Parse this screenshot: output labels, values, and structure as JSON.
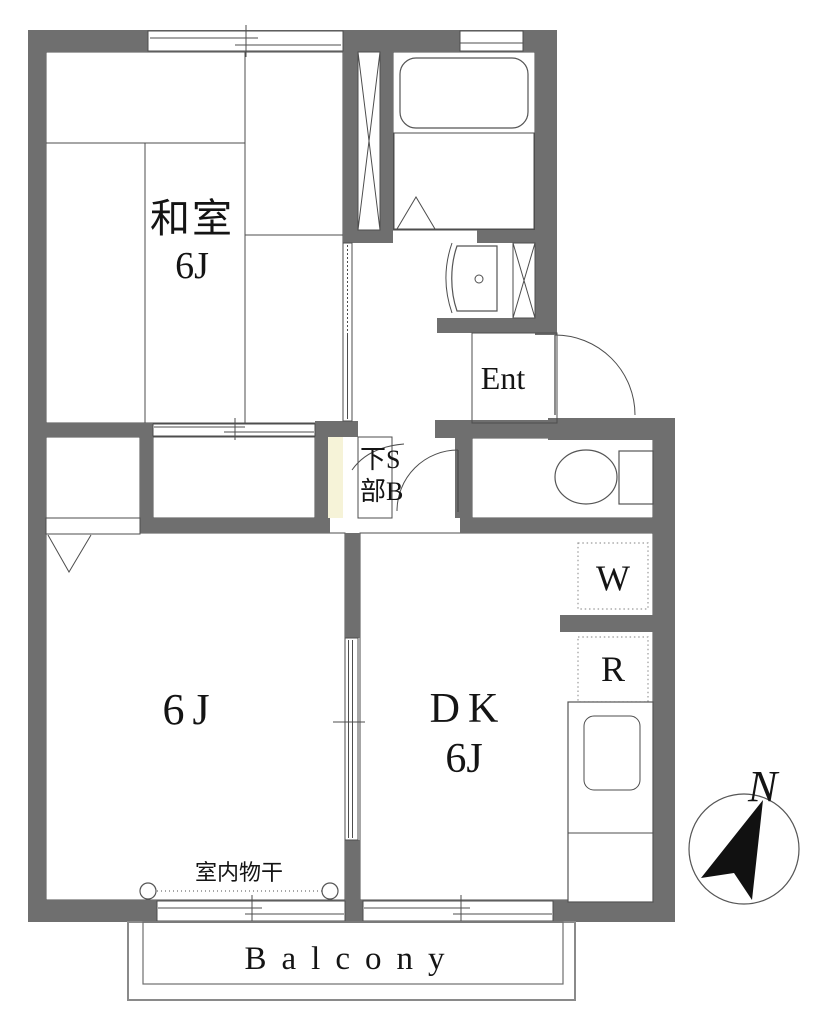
{
  "figure": {
    "type": "apartment-floor-plan"
  },
  "palette": {
    "wall": "#6f6f6f",
    "tatami": "#dfecdf",
    "closet": "#f6f3d8",
    "living": "#eae6db",
    "dining": "#fbdfe1",
    "wet": "#d9e2f1",
    "paper": "#ffffff"
  },
  "rooms": {
    "washitsu": {
      "name": "和室",
      "size": "6J"
    },
    "living": {
      "size": "6J"
    },
    "dining_kitchen": {
      "name": "DK",
      "size": "6J"
    },
    "entrance": {
      "label": "Ent"
    },
    "under_storage": {
      "line1": "下S",
      "line2": "部B"
    },
    "balcony": {
      "label": "Balcony"
    }
  },
  "fixtures": {
    "washer": {
      "label": "W"
    },
    "refrigerator": {
      "label": "R"
    },
    "indoor_drying": {
      "label": "室内物干"
    }
  },
  "compass": {
    "north_label": "N"
  }
}
